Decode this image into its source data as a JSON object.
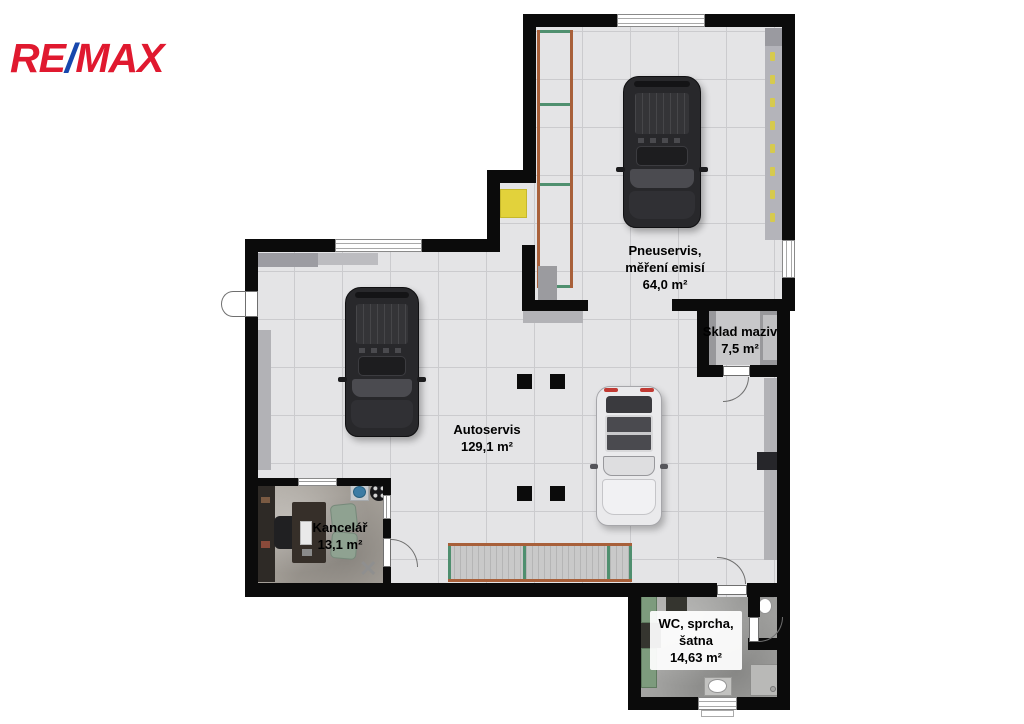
{
  "brand": {
    "logo_re": "RE",
    "logo_slash": "/",
    "logo_max": "MAX",
    "logo_red": "#e0192f",
    "logo_blue": "#1747ad"
  },
  "floorplan": {
    "rooms": {
      "pneuservis": {
        "name_line1": "Pneuservis,",
        "name_line2": "měření emisí",
        "area": "64,0 m²"
      },
      "sklad_maziv": {
        "name_line1": "Sklad maziv",
        "area": "7,5 m²"
      },
      "autoservis": {
        "name_line1": "Autoservis",
        "area": "129,1 m²"
      },
      "kancelar": {
        "name_line1": "Kancelář",
        "area": "13,1 m²",
        "floor_mark": "✕"
      },
      "wc": {
        "name_line1": "WC, sprcha,",
        "name_line2": "šatna",
        "area": "14,63 m²"
      }
    },
    "accents": {
      "rack_rail": "#a8603a",
      "rack_shelf": "#4f8f6f",
      "equipment_highlight": "#e2d23b",
      "locker_green": "#7d9b7d"
    }
  }
}
